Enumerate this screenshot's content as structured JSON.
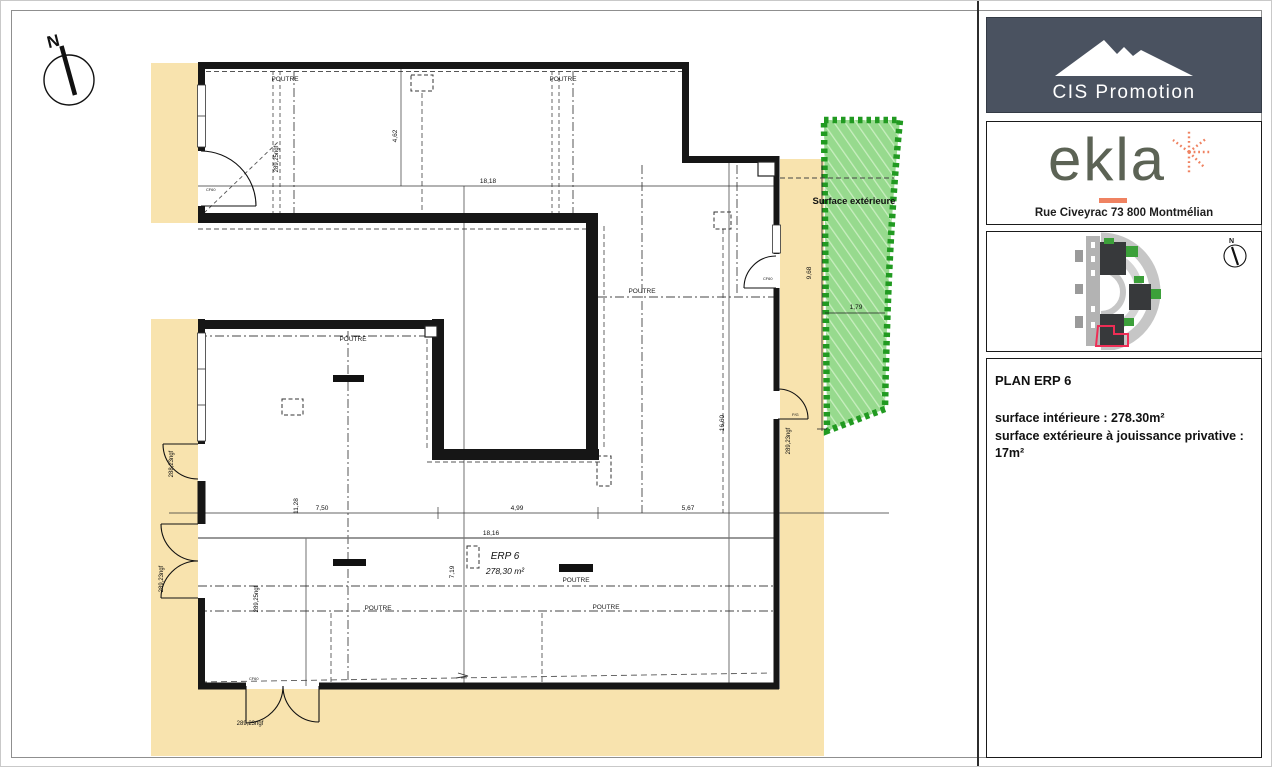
{
  "compass": {
    "label": "N"
  },
  "plan": {
    "labels": {
      "poutre": "POUTRE",
      "surface_exterieure": "Surface extérieure",
      "erp_name": "ERP 6",
      "erp_area": "278,30 m²",
      "cf60": "CF60",
      "pg": "P/G"
    },
    "dimensions": {
      "top_width": "18,18",
      "top_height": "4,62",
      "ext_height": "9,68",
      "ext_width": "1,79",
      "right_height": "16,60",
      "left_height": "11,28",
      "seg1": "7,50",
      "seg2": "4,99",
      "seg3": "5,67",
      "bottom_width": "18,16",
      "mid_height": "7,19"
    },
    "elevations": {
      "interior_upper": "289,25ngf",
      "interior_lower": "289,25ngf",
      "door_left": "288,23ngf",
      "door_left_lower": "289,23ngf",
      "door_right": "289,23ngf",
      "door_bottom": "289,23ngf"
    }
  },
  "sidebar": {
    "cis": {
      "name": "CIS Promotion"
    },
    "ekla": {
      "name": "ekla",
      "address": "Rue Civeyrac 73 800 Montmélian"
    },
    "siteplan": {
      "compass_label": "N"
    },
    "info": {
      "title": "PLAN ERP 6",
      "line1": "surface intérieure : 278.30m²",
      "line2": "surface extérieure à jouissance privative :",
      "line3": "17m²"
    }
  },
  "colors": {
    "beige": "#f8e3ae",
    "green_fill": "#97da8e",
    "green_border": "#219a21",
    "wall": "#161616",
    "cis_background": "#4a5260",
    "ekla_text": "#5c6355",
    "ekla_accent": "#ef8261",
    "siteplan_red_outline": "#ee2d55"
  }
}
